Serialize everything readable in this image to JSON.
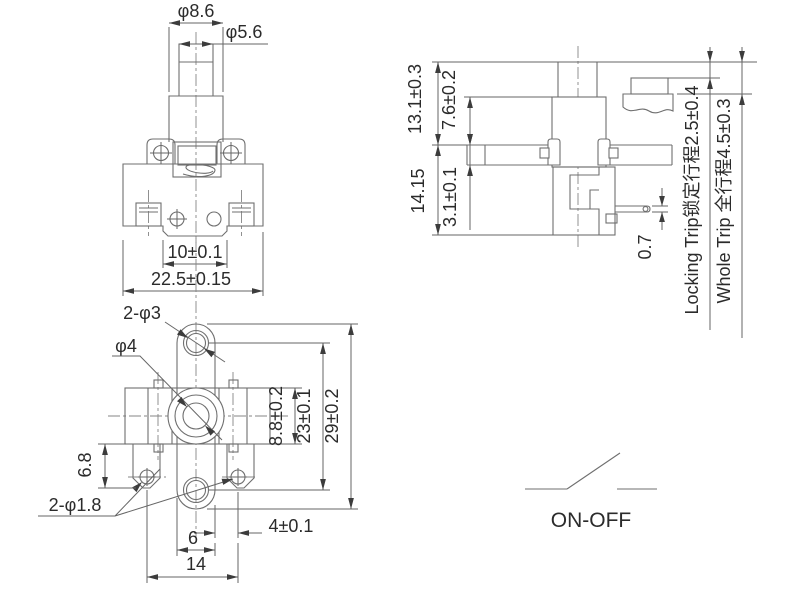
{
  "drawing": {
    "title": "Push button switch engineering drawing",
    "colors": {
      "line": "#6f6f6f",
      "dim_line": "#666666",
      "arrow": "#3c3c3c",
      "text": "#2b2b2b",
      "background": "#ffffff"
    },
    "front_view": {
      "dims": {
        "plunger_outer_dia": "φ8.6",
        "plunger_inner_dia": "φ5.6",
        "notch_width": "10±0.1",
        "body_width": "22.5±0.15"
      }
    },
    "side_view": {
      "dims": {
        "height_top": "13.1±0.3",
        "cap_height": "7.6±0.2",
        "height_bottom": "14.15",
        "plate_thickness": "3.1±0.1",
        "pin_thickness": "0.7",
        "locking_trip": "Locking Trip锁定行程2.5±0.4",
        "whole_trip": "Whole Trip 全行程4.5±0.3"
      }
    },
    "top_view": {
      "dims": {
        "bracket_holes": "2-φ3",
        "center_hole": "φ4",
        "body_depth": "8.8±0.2",
        "hole_pitch": "23±0.1",
        "bracket_length": "29±0.2",
        "tab_height": "6.8",
        "tab_holes": "2-φ1.8",
        "offset": "4±0.1",
        "bracket_width": "6",
        "tab_pitch": "14"
      }
    },
    "symbol": {
      "label": "ON-OFF"
    }
  }
}
